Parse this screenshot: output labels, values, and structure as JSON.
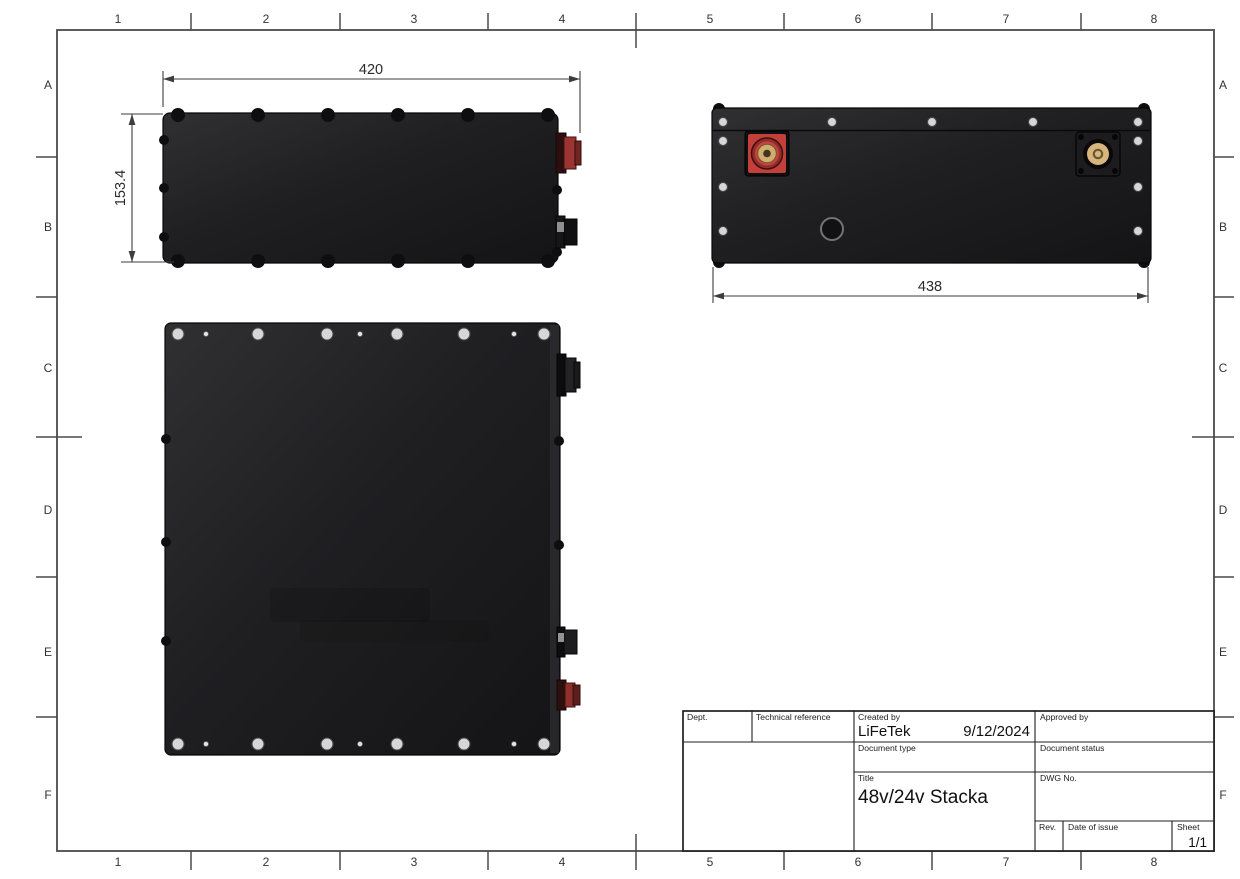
{
  "drawing": {
    "type": "engineering-drawing",
    "description": "Battery pack orthographic views with title block"
  },
  "zones": {
    "column_labels": [
      "1",
      "2",
      "3",
      "4",
      "5",
      "6",
      "7",
      "8"
    ],
    "column_centers_x": [
      118,
      266,
      414,
      562,
      710,
      858,
      1006,
      1154
    ],
    "column_ticks_x": [
      191,
      340,
      488,
      636,
      784,
      932,
      1081
    ],
    "column_long_tick_x": 636,
    "row_labels": [
      "A",
      "B",
      "C",
      "D",
      "E",
      "F"
    ],
    "row_centers_y": [
      85,
      227,
      368,
      510,
      652,
      795
    ],
    "row_ticks_y": [
      157,
      297,
      437,
      577,
      717
    ],
    "row_long_tick_y": 437
  },
  "views": {
    "side_view": {
      "width_dim": "420",
      "height_dim": "153.4",
      "edge_screws_x": [
        178,
        258,
        328,
        398,
        468,
        548
      ],
      "left_bumps_y": [
        140,
        188,
        237
      ],
      "right_bumps_y": [
        190,
        252
      ]
    },
    "front_view": {
      "width_dim": "438",
      "top_screws_x": [
        723,
        832,
        932,
        1033,
        1138
      ],
      "side_screws_y": [
        141,
        187,
        231
      ],
      "corner_bumps": [
        [
          719,
          109
        ],
        [
          1144,
          109
        ],
        [
          719,
          262
        ],
        [
          1144,
          262
        ]
      ]
    },
    "top_view": {
      "fasteners_x": [
        178,
        206,
        258,
        327,
        360,
        397,
        464,
        514,
        544
      ],
      "fastener_sizes": [
        "L",
        "S",
        "L",
        "L",
        "S",
        "L",
        "L",
        "S",
        "L"
      ],
      "left_bumps_y": [
        439,
        542,
        641
      ],
      "right_bumps_y": [
        441,
        545
      ]
    }
  },
  "title_block": {
    "dept_label": "Dept.",
    "technical_reference_label": "Technical reference",
    "created_by_label": "Created by",
    "created_by_value": "LiFeTek",
    "created_date_value": "9/12/2024",
    "approved_by_label": "Approved by",
    "document_type_label": "Document type",
    "document_status_label": "Document status",
    "title_label": "Title",
    "title_value": "48v/24v Stacka",
    "dwg_no_label": "DWG No.",
    "rev_label": "Rev.",
    "date_of_issue_label": "Date of issue",
    "sheet_label": "Sheet",
    "sheet_value": "1/1"
  },
  "colors": {
    "line": "#3d3d3d",
    "frame": "#4a4a4a",
    "screw_light": "#d6d6d6",
    "screw_dark": "#0e0e10",
    "terminal_red": "#c23f3a",
    "terminal_red_dark": "#932e2a",
    "brass": "#d3ac6e",
    "brass_dark": "#423722",
    "connector_red": "#8e302d",
    "titleblock_line": "#1f1f1f",
    "body_dark": "#141416"
  }
}
